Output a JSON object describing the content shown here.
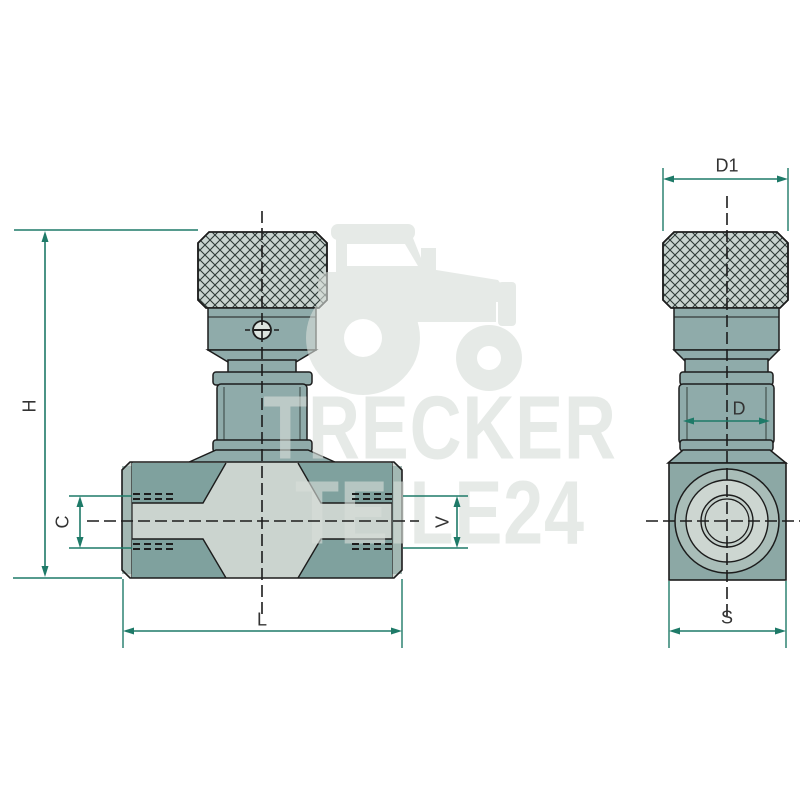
{
  "drawing": {
    "type": "technical-diagram-two-views",
    "front_view": {
      "dimensions": [
        "H",
        "C",
        "V",
        "L"
      ]
    },
    "side_view": {
      "dimensions": [
        "D1",
        "D",
        "S"
      ]
    }
  },
  "labels": {
    "H": "H",
    "C": "C",
    "V": "V",
    "L": "L",
    "D1": "D1",
    "D": "D",
    "S": "S"
  },
  "watermark": {
    "line1": "TRECKER",
    "line2": "TEILE24",
    "icon": "tractor-icon"
  },
  "colors": {
    "dimension_line": "#1e7a68",
    "label_text": "#333333",
    "outline": "#1c1c1c",
    "body_dark": "#7fa19e",
    "body_mid": "#8fabaa",
    "body_light": "#cbd4cf",
    "knob_fill": "#c9d4d0",
    "square_fill": "#8ca8a5",
    "watermark": "#e8eae8",
    "background": "#ffffff"
  }
}
